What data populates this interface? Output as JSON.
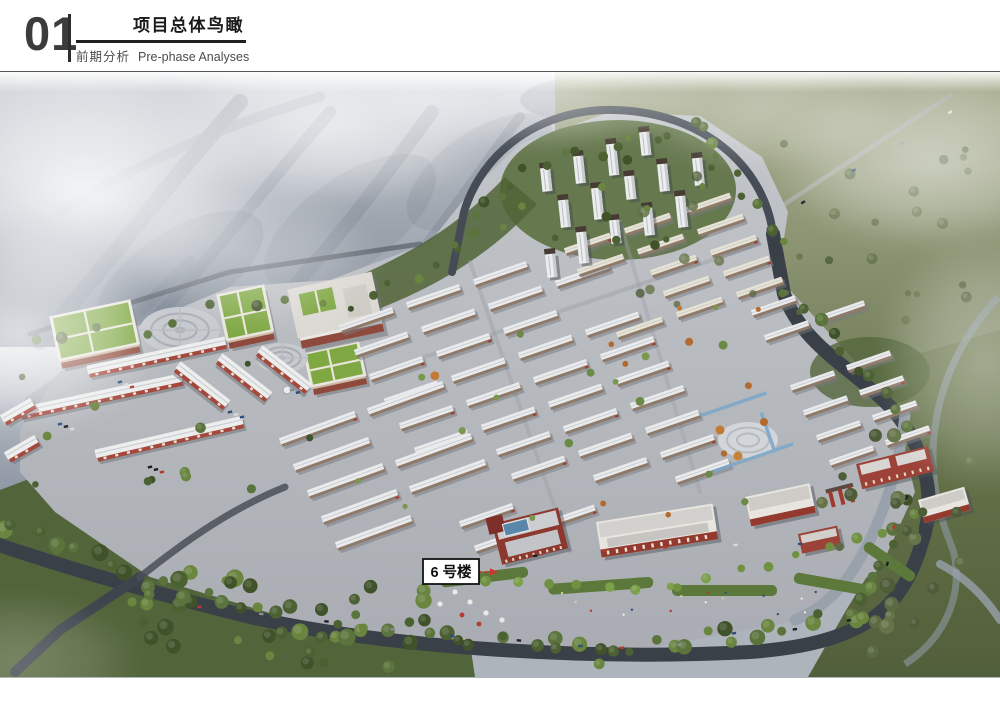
{
  "header": {
    "section_number": "01",
    "title": "项目总体鸟瞰",
    "subtitle_cn": "前期分析",
    "subtitle_en": "Pre-phase Analyses"
  },
  "annotation": {
    "building_label": "6 号楼"
  },
  "colors": {
    "header_number": "#3c3c3c",
    "title_text": "#1b1b1b",
    "subtitle_text": "#4d4d4d",
    "divider": "#2d2d2d",
    "label_border": "#121212",
    "label_bg": "#ffffff",
    "label_arrow": "#c6392c",
    "mountain": "#929aa6",
    "field_green": "#66744a",
    "road_dark": "#3a4048",
    "ground_plate": "#b7bac0",
    "green_roof": "#7fa843",
    "red_brown_wall": "#964033",
    "house_roof": "#e9eaec",
    "water": "#7fa8c9"
  }
}
